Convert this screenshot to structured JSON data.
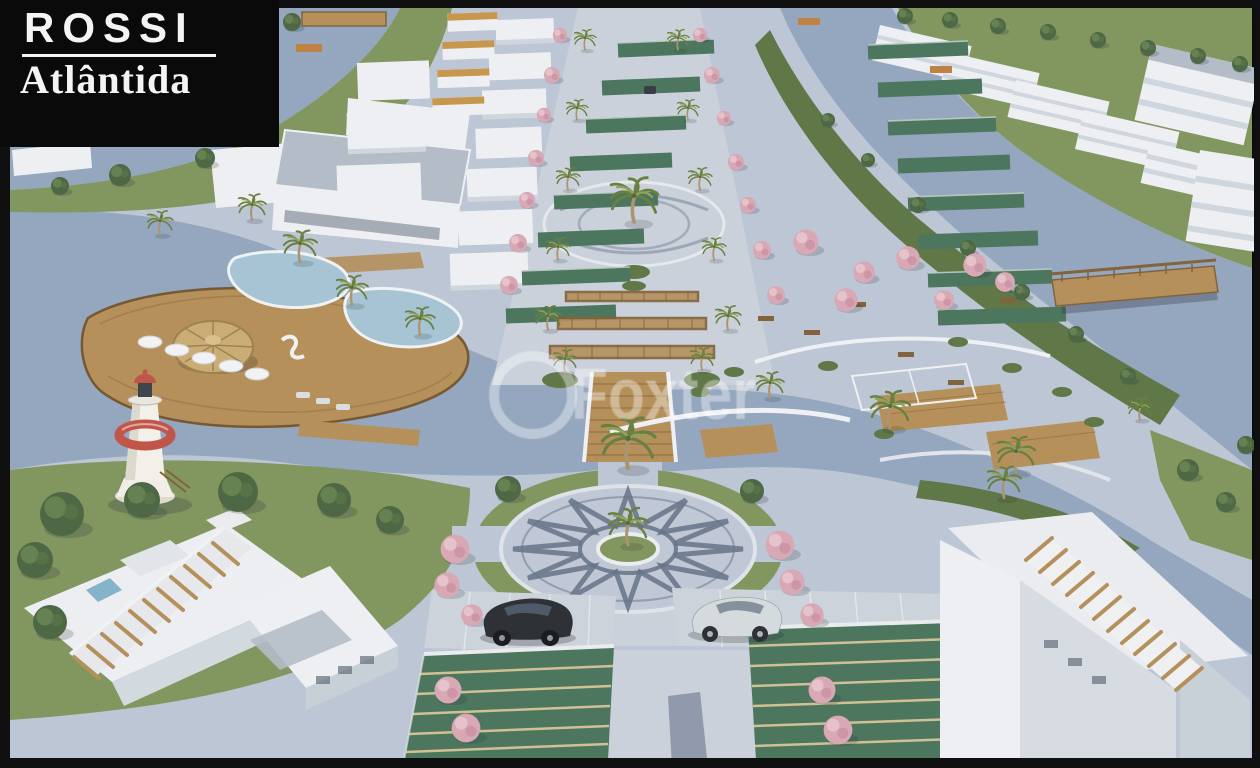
{
  "logo": {
    "brand": "ROSSI",
    "project": "Atlântida"
  },
  "watermark": {
    "text": "Foxter"
  },
  "scene": {
    "description": "Aerial 3D rendering of the Rossi Atlântida waterfront masterplan: canals with wooden bridges, lagoon pool deck with thatched kiosk and lighthouse, palm-lined central boulevard, mosaic star plaza with two parked cars, rows of green carport roofs and white residential buildings with rooftop pergolas.",
    "landmarks": [
      "canal-waterways",
      "lagoon-pool-deck",
      "thatched-kiosk",
      "lighthouse",
      "palm-boulevard",
      "upper-roundabout",
      "pergola-walkway",
      "wooden-bridge",
      "sports-court",
      "star-mosaic-plaza",
      "parked-cars",
      "carport-rows",
      "residential-blocks",
      "rooftop-pergolas",
      "pink-flowering-trees"
    ],
    "colors": {
      "frame": "#0c0c0c",
      "logo_bg": "#0a0a0a",
      "logo_text": "#f4f4f4",
      "water": "#8ca3bf",
      "pool": "#9fc2d6",
      "pavement": "#b9c3d5",
      "pavement_light": "#c7cfdd",
      "pavement_dark": "#a9b4c8",
      "grass": "#7a9154",
      "grass_dark": "#55703c",
      "foliage": "#42603a",
      "roof_green": "#3e7056",
      "carport_stripe": "#cebe8e",
      "building": "#edf0f5",
      "building_shade": "#ccd4df",
      "roof_gray": "#aeb9c9",
      "glass": "#5f6d80",
      "wood": "#b3894f",
      "wood_dark": "#7c5a2e",
      "thatch": "#c9a96b",
      "lighthouse_red": "#c34a3e",
      "pink": "#d9a4b4",
      "pink_light": "#e9c3cf",
      "trunk": "#a98f62",
      "palm": "#5f7a35",
      "star": "#5a6b85",
      "car_dark": "#20262e",
      "car_silver": "#d2d8de",
      "watermark": "rgba(255,255,255,0.38)"
    }
  }
}
